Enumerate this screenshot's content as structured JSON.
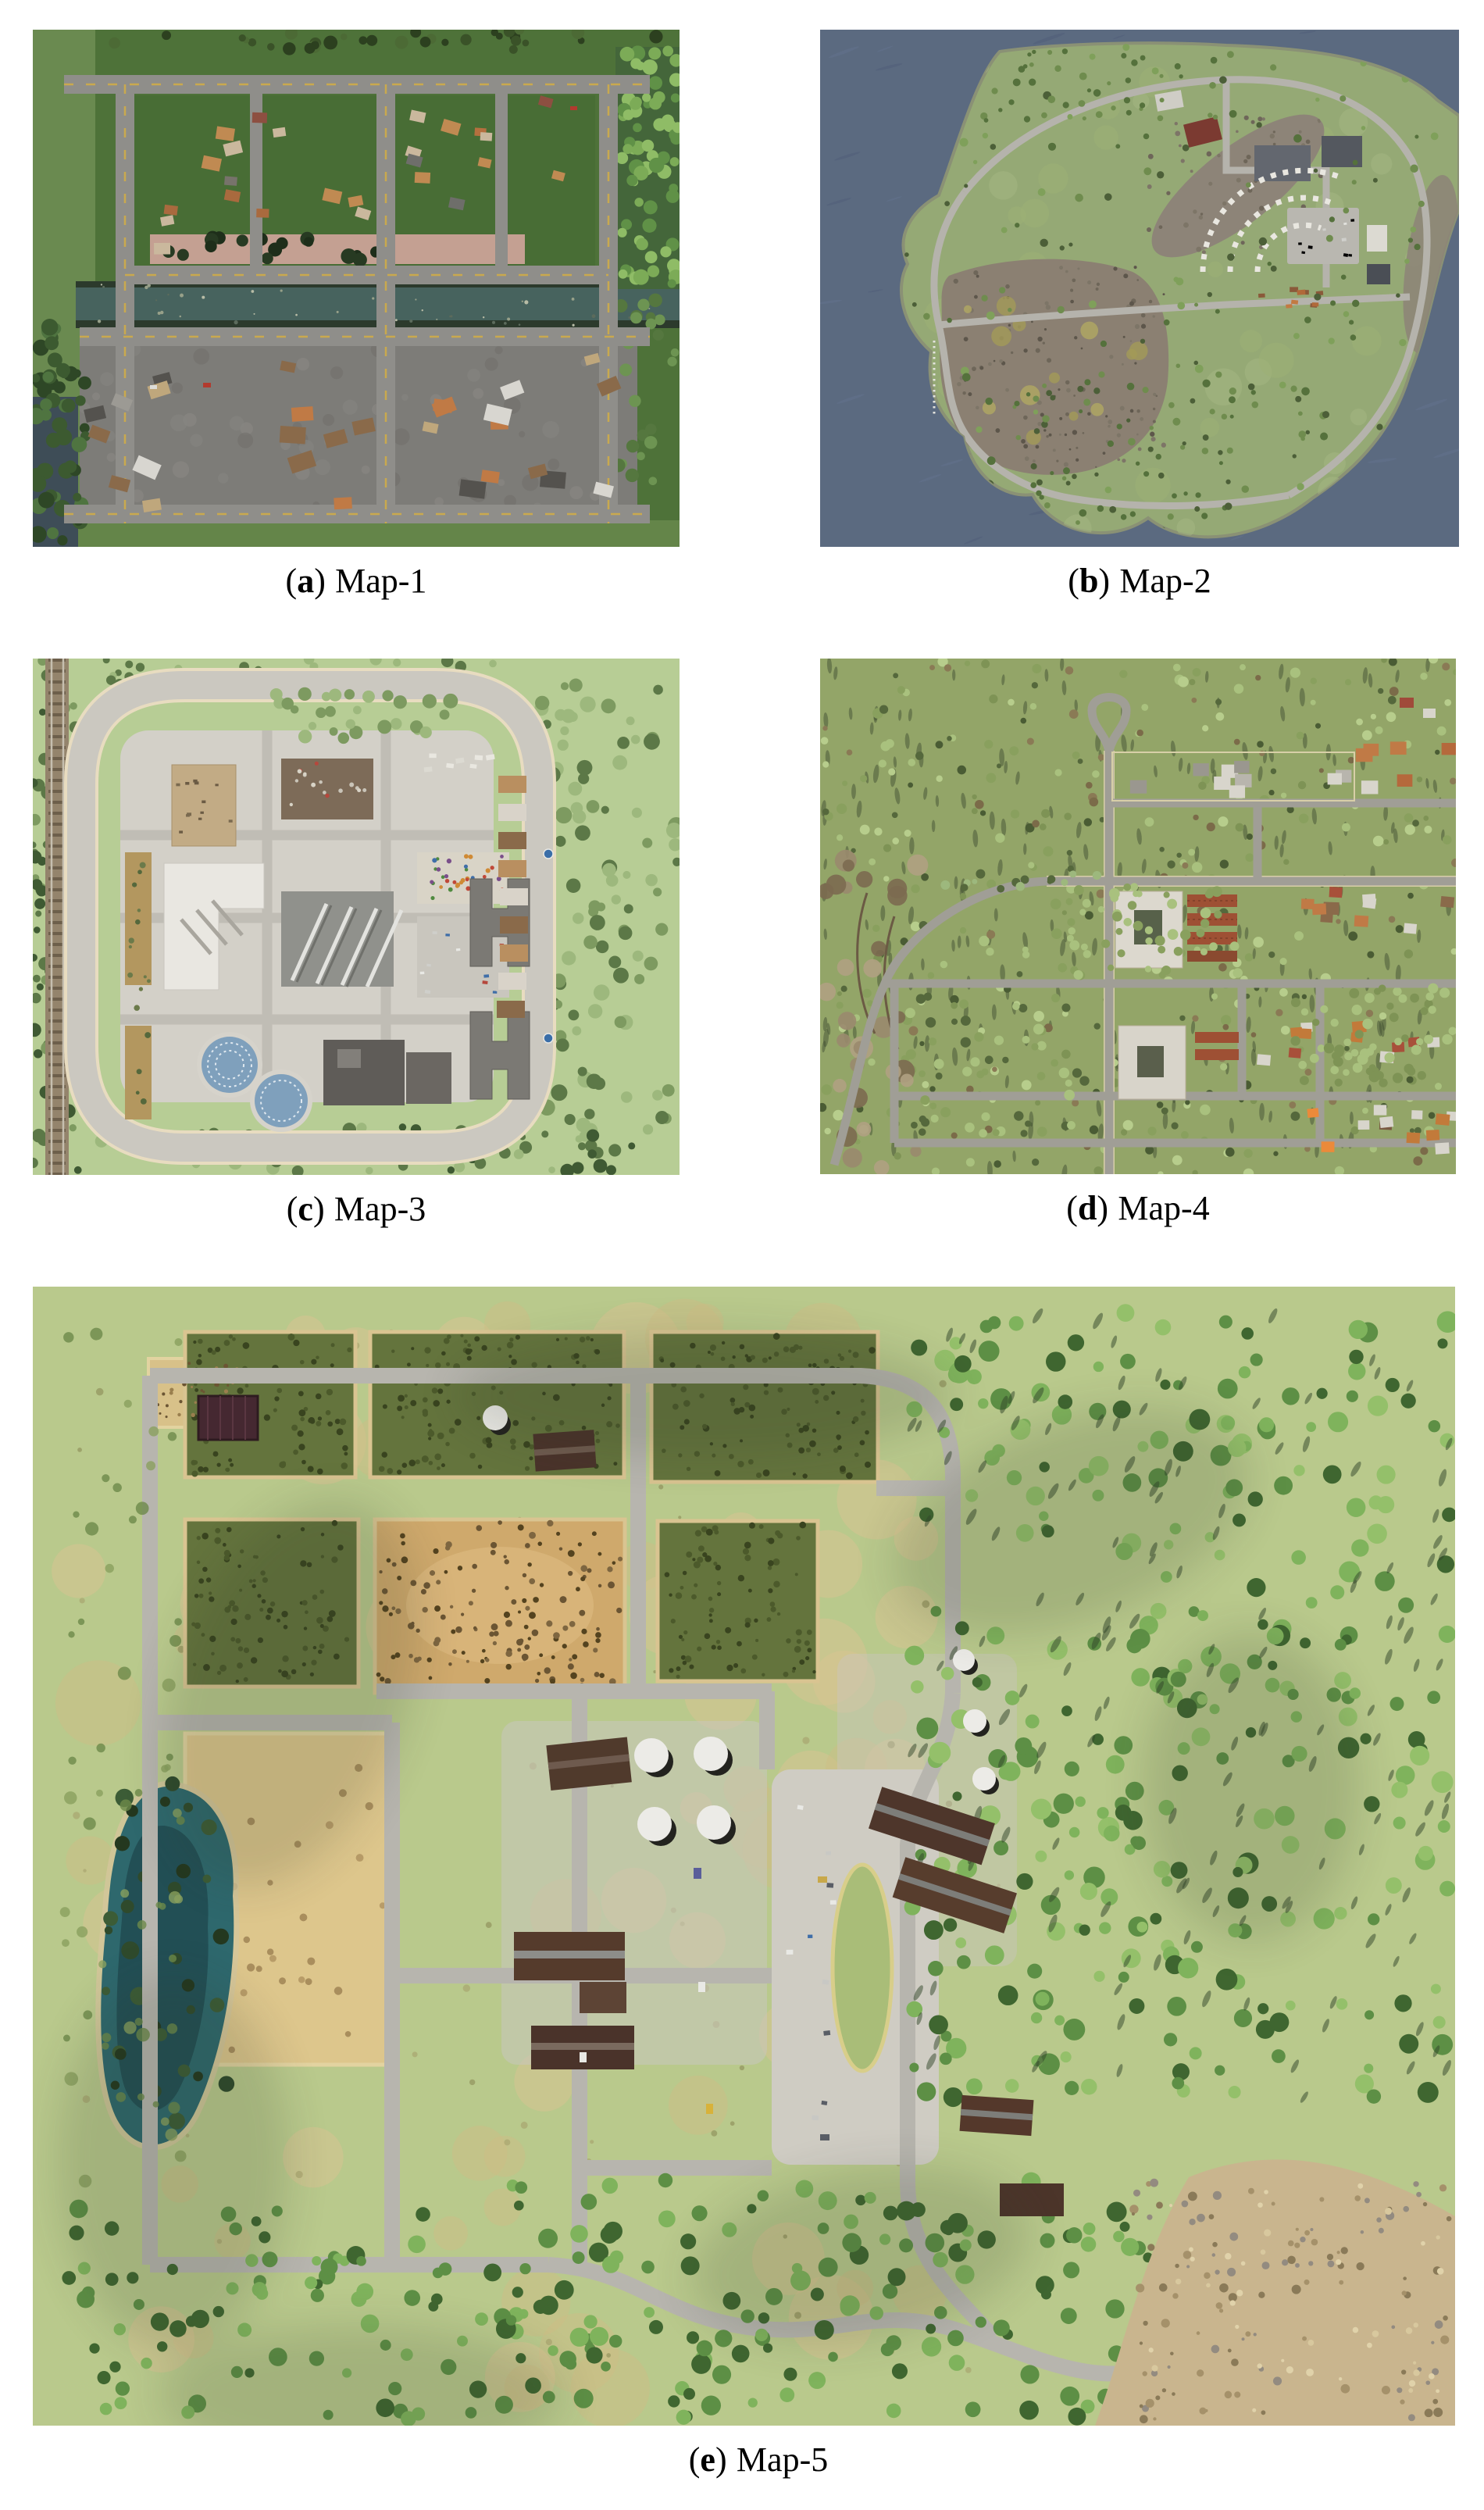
{
  "page": {
    "background": "#ffffff"
  },
  "figure": {
    "caption_paren_open": "(",
    "caption_paren_close": ")",
    "panels": [
      {
        "letter": "a",
        "title": "Map-1",
        "palette": {
          "ground": "#4e7239",
          "road": "#8f8e8a",
          "canal": "#47635e",
          "industrial": "#7d7c78"
        }
      },
      {
        "letter": "b",
        "title": "Map-2",
        "palette": {
          "water": "#5b6a80",
          "island": "#95a975",
          "road": "#b5b3ac",
          "rock": "#8b8072"
        }
      },
      {
        "letter": "c",
        "title": "Map-3",
        "palette": {
          "grass": "#b7cd95",
          "road": "#cbc8c0",
          "pavement": "#d3d0c8"
        }
      },
      {
        "letter": "d",
        "title": "Map-4",
        "palette": {
          "grass": "#93a568",
          "road": "#a09e96"
        }
      },
      {
        "letter": "e",
        "title": "Map-5",
        "palette": {
          "grass": "#b9c98c",
          "road": "#b7b5ae",
          "pond": "#2e686d",
          "field_dark": "#64743d",
          "field_wheat": "#ddc68c",
          "field_dirt": "#cfa96c"
        }
      }
    ]
  }
}
